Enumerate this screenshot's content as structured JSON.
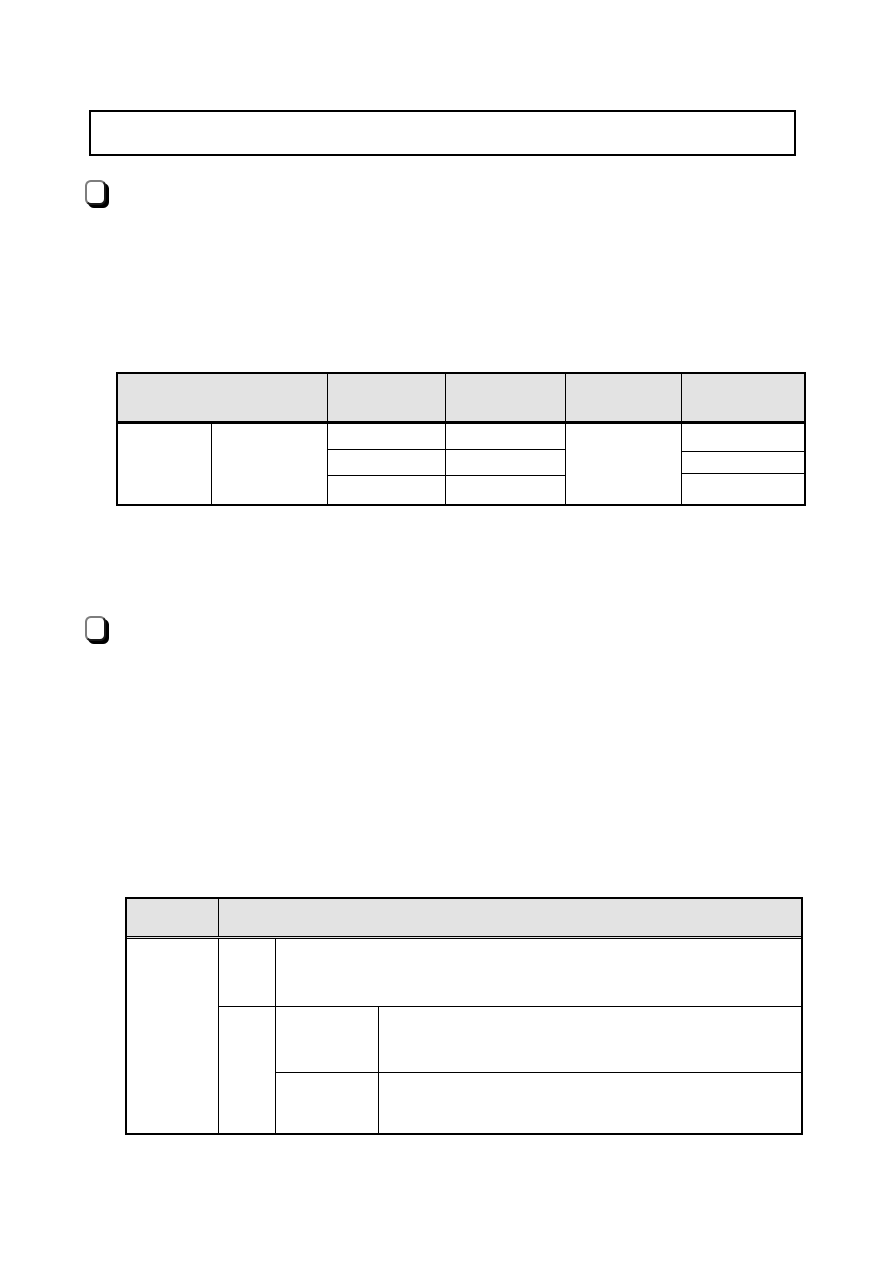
{
  "page": {
    "background": "#ffffff",
    "kind": "blank-document-template-page"
  },
  "colors": {
    "table_header_bg": "#e3e3e3",
    "table_border": "#000000",
    "icon_shadow": "#000000",
    "icon_border_light": "#7d7d7d",
    "icon_border_dark": "#1a1a1a"
  },
  "notice_box": {
    "content": ""
  },
  "sections": [
    {
      "icon": "square-bullet-icon",
      "heading": ""
    },
    {
      "icon": "square-bullet-icon",
      "heading": ""
    }
  ],
  "table1": {
    "header": [
      "",
      "",
      "",
      "",
      ""
    ],
    "col_a": "",
    "col_b": "",
    "col_c_rows": [
      "",
      "",
      ""
    ],
    "col_d_rows": [
      "",
      "",
      ""
    ],
    "col_e": "",
    "col_f_rows": [
      "",
      "",
      ""
    ]
  },
  "table2": {
    "header": [
      "",
      ""
    ],
    "col1": "",
    "row1": {
      "key": "",
      "value": ""
    },
    "col2": "",
    "row2": {
      "key": "",
      "value": ""
    },
    "row3": {
      "key": "",
      "value": ""
    }
  }
}
